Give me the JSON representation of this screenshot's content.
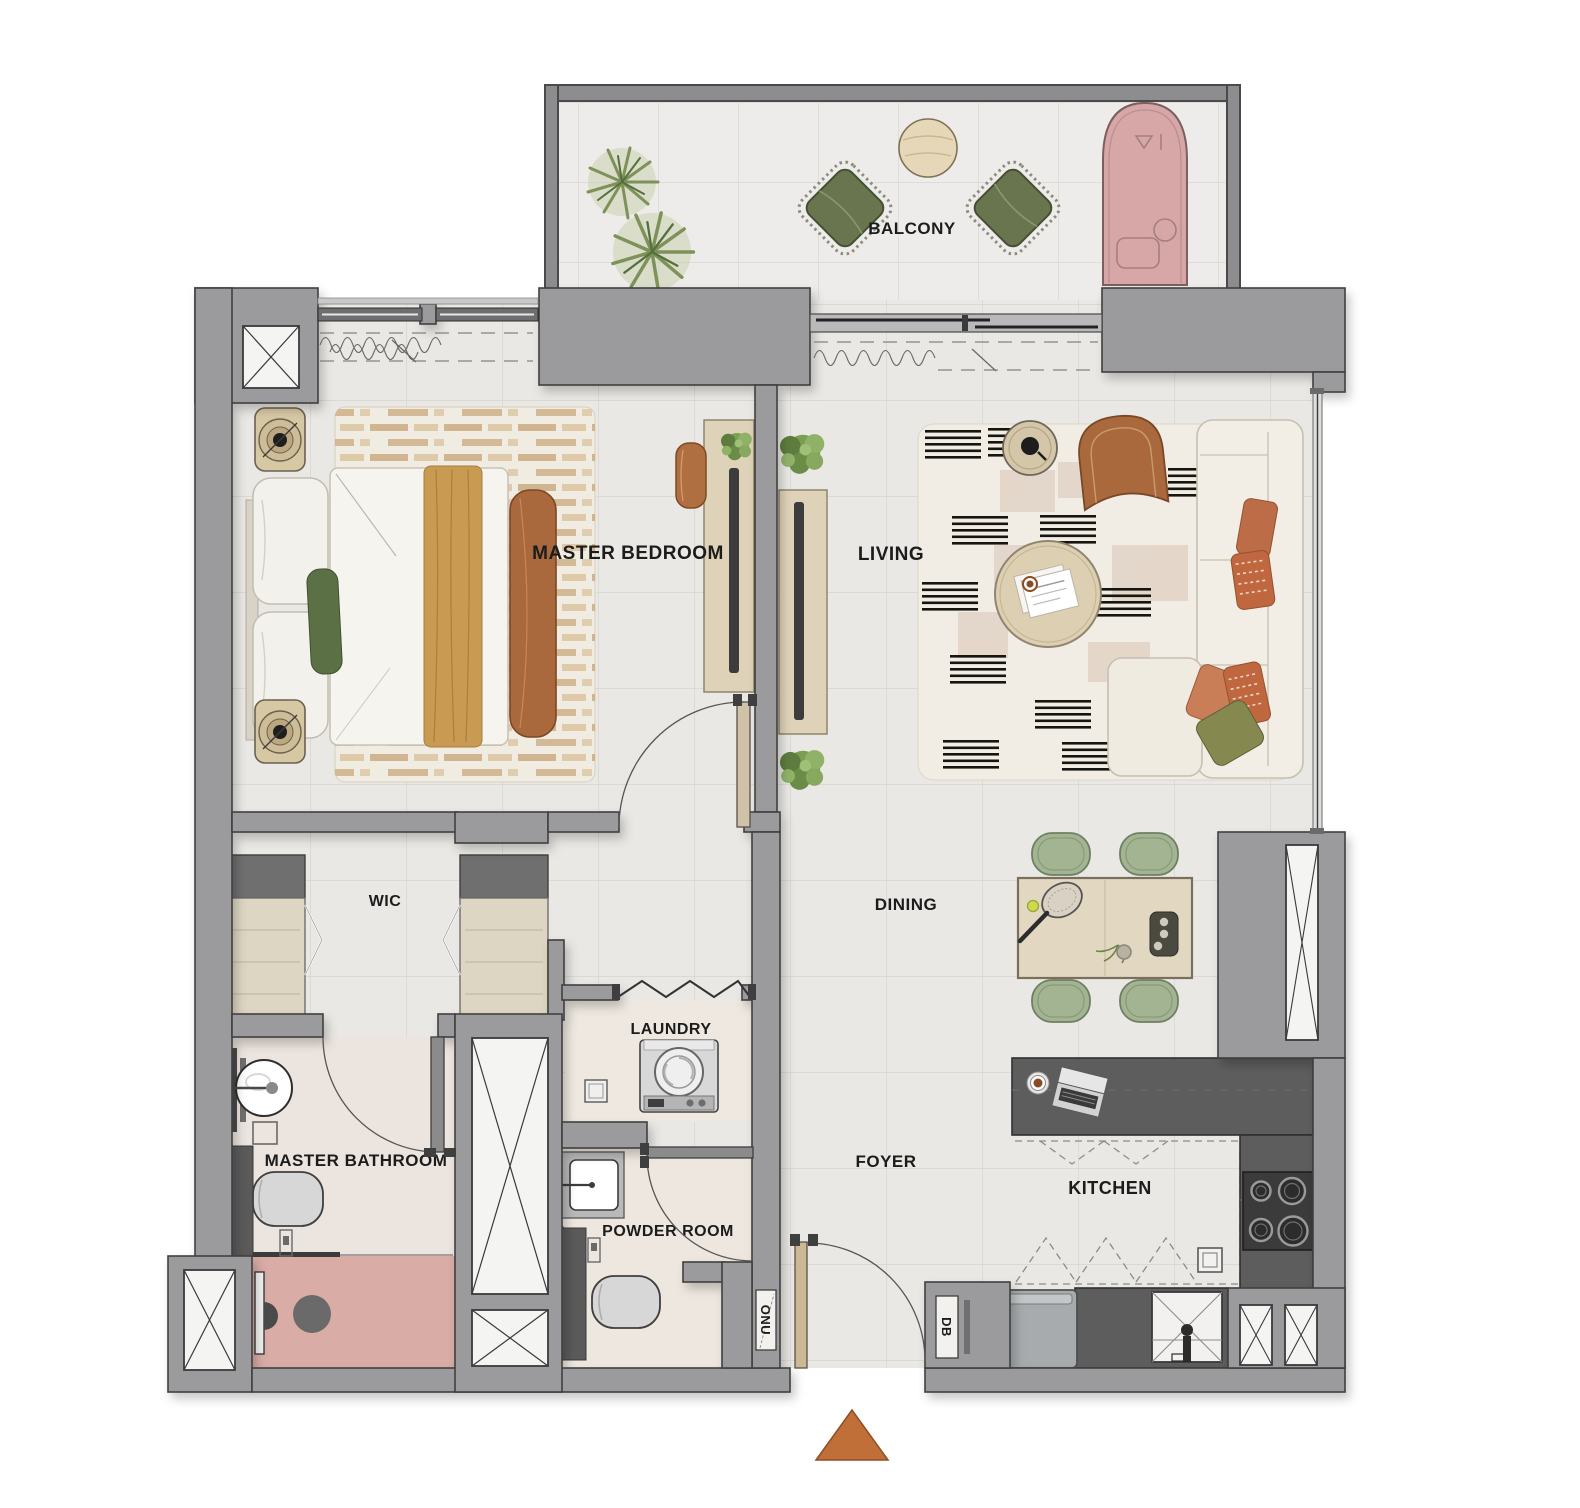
{
  "plan": {
    "type": "apartment-floor-plan",
    "rooms": {
      "balcony": {
        "label": "BALCONY"
      },
      "master_bedroom": {
        "label": "MASTER BEDROOM"
      },
      "living": {
        "label": "LIVING"
      },
      "wic": {
        "label": "WIC"
      },
      "dining": {
        "label": "DINING"
      },
      "laundry": {
        "label": "LAUNDRY"
      },
      "master_bathroom": {
        "label": "MASTER BATHROOM"
      },
      "foyer": {
        "label": "FOYER"
      },
      "powder_room": {
        "label": "POWDER ROOM"
      },
      "kitchen": {
        "label": "KITCHEN"
      }
    },
    "utility_labels": {
      "onu": "ONU",
      "db": "DB"
    },
    "markers": {
      "entrance_icon": "orange-triangle"
    },
    "palette": {
      "wall_gray": "#9b9b9d",
      "wall_outline": "#3f3f3f",
      "floor_light": "#eae8e4",
      "tile_line": "#d7d3cd",
      "counter_dark": "#5d5d5d",
      "shower_pink": "#d9aca6",
      "daybed_pink": "#d7a7a7",
      "leather_brown": "#a9693d",
      "wood_light": "#ddd2b8",
      "runner_tan": "#c89a52",
      "sage_green": "#a3b492",
      "olive_green": "#68754e",
      "rug_cream": "#f1ede5",
      "accent_orange": "#c06f38"
    }
  }
}
